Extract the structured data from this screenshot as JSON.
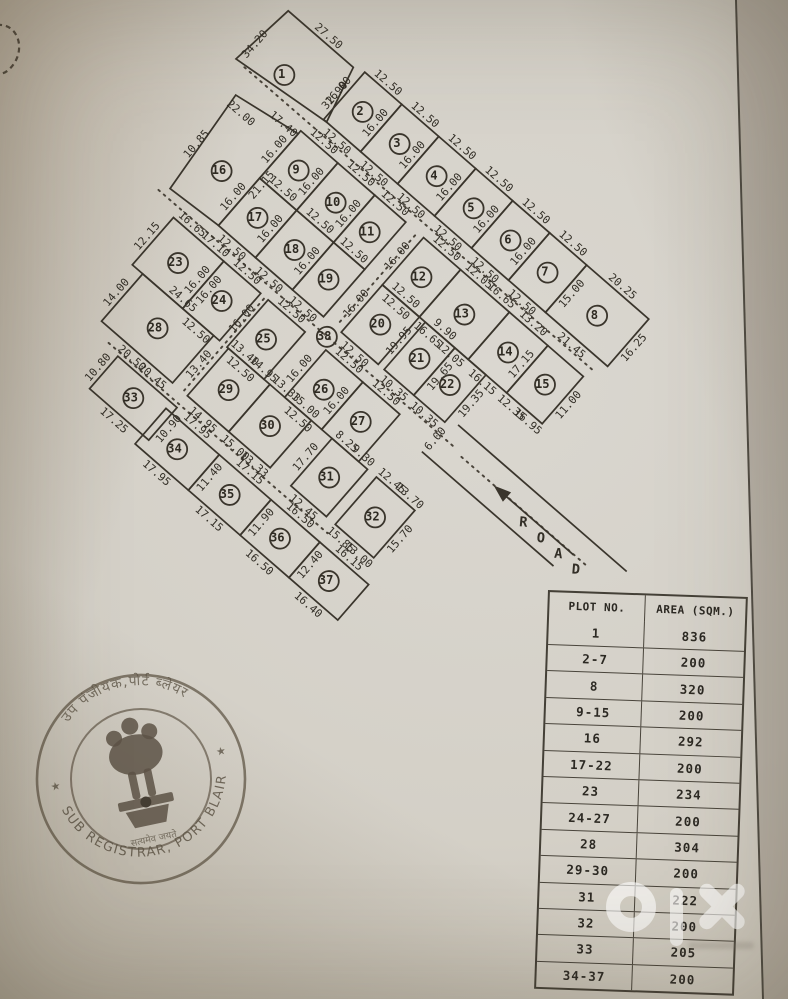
{
  "document": {
    "type_label": "site plan scan"
  },
  "table": {
    "headers": [
      "PLOT NO.",
      "AREA (SQM.)"
    ],
    "rows": [
      [
        "1",
        "836"
      ],
      [
        "2-7",
        "200"
      ],
      [
        "8",
        "320"
      ],
      [
        "9-15",
        "200"
      ],
      [
        "16",
        "292"
      ],
      [
        "17-22",
        "200"
      ],
      [
        "23",
        "234"
      ],
      [
        "24-27",
        "200"
      ],
      [
        "28",
        "304"
      ],
      [
        "29-30",
        "200"
      ],
      [
        "31",
        "222"
      ],
      [
        "32",
        "200"
      ],
      [
        "33",
        "205"
      ],
      [
        "34-37",
        "200"
      ]
    ]
  },
  "seal": {
    "top_text": "उप पंजीयक,पोर्ट ब्लेयर",
    "bottom_text": "SUB REGISTRAR, PORT BLAIR",
    "motto": "सत्यमेव जयते",
    "star": "★",
    "ink_color": "#564b3b"
  },
  "watermark": {
    "brand": "olx",
    "color": "#ffffff"
  },
  "colors": {
    "paper": "#d4d0c7",
    "ink": "#3a352c",
    "photo_edge": "#b0a898"
  },
  "map": {
    "road_label": "ROAD",
    "road_letter_pos": [
      [
        136.5,
        61
      ],
      [
        142.5,
        61.1
      ],
      [
        148.5,
        61.2
      ],
      [
        154.5,
        61.3
      ]
    ],
    "width_marks": [
      {
        "t": "6.00",
        "x": 105.8,
        "y": 58.8
      }
    ],
    "transform": {
      "ox": 276,
      "oy": -5,
      "deg": 41,
      "scale": 3.92
    },
    "roads_dotted": [
      [
        6,
        19.2,
        124,
        19.2
      ],
      [
        10,
        57.2,
        110,
        57.2
      ],
      [
        26,
        95,
        100,
        95
      ],
      [
        67,
        23,
        67,
        53.5
      ],
      [
        48.5,
        60.5,
        48.5,
        91.5
      ],
      [
        113,
        57.9,
        156,
        57.9
      ]
    ],
    "exit_lines": [
      [
        107,
        52.3,
        164,
        52.3
      ],
      [
        104.5,
        63.5,
        149,
        63.5
      ]
    ],
    "arrow_shaft": [
      151,
      58,
      126,
      58
    ],
    "arrow_head": "124,58 128.5,56.4 128.5,59.6",
    "plots": [
      {
        "n": "1",
        "poly": [
          [
            5,
            1
          ],
          [
            27,
            1
          ],
          [
            31,
            16
          ],
          [
            3,
            19
          ]
        ],
        "r": [
          3,
          1,
          28,
          18
        ],
        "c": [
          15,
          14
        ],
        "L": [
          [
            "27.50",
            "t"
          ],
          [
            "34.20",
            "@p",
            5,
            13
          ],
          [
            "32.90",
            "@p",
            29,
            9.5
          ]
        ]
      },
      {
        "n": "2",
        "r": [
          30,
          0,
          12.5,
          16
        ],
        "L": [
          [
            "12.50",
            "t"
          ],
          [
            "16.00",
            "l"
          ],
          [
            "12.50",
            "b"
          ]
        ]
      },
      {
        "n": "3",
        "r": [
          42.5,
          0,
          12.5,
          16
        ],
        "L": [
          [
            "12.50",
            "t"
          ],
          [
            "16.00",
            "l"
          ],
          [
            "12.50",
            "b"
          ]
        ]
      },
      {
        "n": "4",
        "r": [
          55,
          0,
          12.5,
          16
        ],
        "L": [
          [
            "12.50",
            "t"
          ],
          [
            "16.00",
            "l"
          ],
          [
            "12.50",
            "b"
          ]
        ]
      },
      {
        "n": "5",
        "r": [
          67.5,
          0,
          12.5,
          16
        ],
        "L": [
          [
            "12.50",
            "t"
          ],
          [
            "16.00",
            "l"
          ],
          [
            "12.50",
            "b"
          ]
        ]
      },
      {
        "n": "6",
        "r": [
          80,
          0,
          12.5,
          16
        ],
        "L": [
          [
            "12.50",
            "t"
          ],
          [
            "16.00",
            "l"
          ],
          [
            "12.50",
            "b"
          ]
        ]
      },
      {
        "n": "7",
        "r": [
          92.5,
          0,
          12.5,
          16
        ],
        "L": [
          [
            "12.50",
            "t"
          ],
          [
            "16.00",
            "l"
          ],
          [
            "15.00",
            "r"
          ],
          [
            "12.50",
            "b"
          ]
        ]
      },
      {
        "n": "8",
        "r": [
          105,
          0,
          21,
          16
        ],
        "L": [
          [
            "20.25",
            "t"
          ],
          [
            "16.25",
            "r"
          ],
          [
            "21.45",
            "b"
          ]
        ]
      },
      {
        "n": "16",
        "poly": [
          [
            9,
            26
          ],
          [
            27.5,
            23
          ],
          [
            27.5,
            54
          ],
          [
            12,
            55
          ]
        ],
        "r": [
          9,
          23,
          18.5,
          32
        ],
        "c": [
          19,
          43
        ],
        "L": [
          [
            "22.00",
            "@a",
            13,
            29.5
          ],
          [
            "17.40",
            "@a",
            23,
            24.5
          ],
          [
            "21.15",
            "@p",
            29.9,
            39
          ],
          [
            "10.85",
            "@p",
            10.5,
            42
          ]
        ]
      },
      {
        "n": "9",
        "r": [
          27.5,
          22,
          12.5,
          16
        ],
        "L": [
          [
            "12.50",
            "t"
          ],
          [
            "16.00",
            "l"
          ]
        ]
      },
      {
        "n": "10",
        "r": [
          40,
          22,
          12.5,
          16
        ],
        "L": [
          [
            "12.50",
            "t"
          ],
          [
            "16.00",
            "l"
          ]
        ]
      },
      {
        "n": "11",
        "r": [
          52.5,
          22,
          10.5,
          16
        ],
        "L": [
          [
            "12.50",
            "t"
          ],
          [
            "16.00",
            "l"
          ]
        ]
      },
      {
        "n": "12",
        "r": [
          69,
          22,
          12.5,
          16
        ],
        "L": [
          [
            "12.50",
            "t"
          ],
          [
            "16.00",
            "l"
          ],
          [
            "12.50",
            "b"
          ]
        ]
      },
      {
        "n": "13",
        "r": [
          81.5,
          22,
          16.5,
          16
        ],
        "L": [
          [
            "12.05",
            "t1"
          ],
          [
            "16.65",
            "t2"
          ],
          [
            "16.65",
            "b1"
          ],
          [
            "12.05",
            "b2"
          ]
        ]
      },
      {
        "n": "14",
        "r": [
          98,
          22,
          13,
          16
        ],
        "L": [
          [
            "13.20",
            "t"
          ],
          [
            "16.15",
            "b"
          ]
        ]
      },
      {
        "n": "15",
        "r": [
          111,
          22,
          12,
          16
        ],
        "L": [
          [
            "17.15",
            "l"
          ],
          [
            "11.00",
            "r"
          ],
          [
            "12.35",
            "b1"
          ],
          [
            "16.95",
            "b2"
          ]
        ]
      },
      {
        "n": "17",
        "r": [
          27.5,
          38,
          12.5,
          16
        ],
        "L": [
          [
            "12.50",
            "t"
          ],
          [
            "16.00",
            "l"
          ],
          [
            "12.50",
            "b"
          ]
        ]
      },
      {
        "n": "18",
        "r": [
          40,
          38,
          12.5,
          16
        ],
        "L": [
          [
            "12.50",
            "t"
          ],
          [
            "16.00",
            "l"
          ],
          [
            "12.50",
            "b"
          ]
        ]
      },
      {
        "n": "19",
        "r": [
          52.5,
          38,
          10.5,
          16
        ],
        "L": [
          [
            "12.50",
            "t"
          ],
          [
            "16.00",
            "l"
          ],
          [
            "12.50",
            "b"
          ]
        ]
      },
      {
        "n": "20",
        "r": [
          69,
          38,
          12.5,
          16
        ],
        "L": [
          [
            "12.50",
            "t"
          ],
          [
            "16.00",
            "l"
          ],
          [
            "12.50",
            "b"
          ]
        ]
      },
      {
        "n": "21",
        "r": [
          83.5,
          38,
          10,
          16
        ],
        "L": [
          [
            "9.90",
            "t"
          ],
          [
            "19.95",
            "l"
          ],
          [
            "19.65",
            "r"
          ],
          [
            "10.35",
            "b"
          ]
        ]
      },
      {
        "n": "22",
        "r": [
          93.5,
          38,
          10.5,
          16
        ],
        "L": [
          [
            "19.35",
            "r"
          ],
          [
            "10.35",
            "b"
          ]
        ]
      },
      {
        "n": "23",
        "r": [
          17.5,
          60,
          17,
          16
        ],
        "L": [
          [
            "16.65",
            "t1"
          ],
          [
            "17.10",
            "t2"
          ],
          [
            "12.15",
            "l"
          ],
          [
            "16.00",
            "r"
          ]
        ]
      },
      {
        "n": "24",
        "r": [
          34.5,
          60,
          12.5,
          16
        ],
        "L": [
          [
            "12.50",
            "t"
          ],
          [
            "16.00",
            "l"
          ],
          [
            "12.50",
            "b"
          ]
        ]
      },
      {
        "n": "25",
        "r": [
          49.5,
          60,
          12.5,
          16
        ],
        "L": [
          [
            "12.50",
            "t"
          ],
          [
            "16.00",
            "l"
          ],
          [
            "12.50",
            "b"
          ]
        ]
      },
      {
        "n": "26",
        "r": [
          69,
          60,
          12.5,
          16
        ],
        "L": [
          [
            "12.50",
            "t"
          ],
          [
            "16.00",
            "l"
          ],
          [
            "12.50",
            "b"
          ]
        ]
      },
      {
        "n": "27",
        "r": [
          81.5,
          60,
          12.5,
          16
        ],
        "L": [
          [
            "12.50",
            "t"
          ],
          [
            "16.00",
            "l"
          ]
        ]
      },
      {
        "n": "28",
        "r": [
          21,
          76,
          24,
          16
        ],
        "L": [
          [
            "24.65",
            "t"
          ],
          [
            "14.00",
            "l"
          ],
          [
            "13.40",
            "r"
          ],
          [
            "20.50",
            "b"
          ]
        ]
      },
      {
        "n": "29",
        "r": [
          50,
          76,
          14,
          16
        ],
        "L": [
          [
            "13.40",
            "t1"
          ],
          [
            "14.95",
            "t2"
          ],
          [
            "14.95",
            "b"
          ]
        ]
      },
      {
        "n": "30",
        "r": [
          64,
          76,
          14,
          16
        ],
        "L": [
          [
            "13.33",
            "t1"
          ],
          [
            "15.00",
            "t2"
          ],
          [
            "15.00",
            "b1"
          ],
          [
            "13.33",
            "b2"
          ]
        ]
      },
      {
        "n": "31",
        "r": [
          85,
          76,
          12,
          16
        ],
        "L": [
          [
            "8.25",
            "t1"
          ],
          [
            "9.30",
            "t2"
          ],
          [
            "17.70",
            "l"
          ],
          [
            "12.45",
            "b"
          ]
        ]
      },
      {
        "n": "32",
        "r": [
          100,
          76,
          13,
          16
        ],
        "L": [
          [
            "12.45",
            "t1"
          ],
          [
            "13.70",
            "t2"
          ],
          [
            "15.70",
            "r"
          ],
          [
            "15.85",
            "b1"
          ],
          [
            "13.00",
            "b2"
          ]
        ]
      },
      {
        "n": "33",
        "r": [
          30,
          96,
          20,
          11
        ],
        "L": [
          [
            "20.45",
            "t"
          ],
          [
            "10.80",
            "l"
          ],
          [
            "10.90",
            "r"
          ],
          [
            "17.25",
            "b"
          ]
        ]
      },
      {
        "n": "34",
        "r": [
          48,
          98,
          18,
          12
        ],
        "L": [
          [
            "17.95",
            "t"
          ],
          [
            "11.40",
            "r"
          ],
          [
            "17.95",
            "b"
          ]
        ]
      },
      {
        "n": "35",
        "r": [
          66,
          98,
          17.5,
          12
        ],
        "L": [
          [
            "17.15",
            "t"
          ],
          [
            "11.90",
            "r"
          ],
          [
            "17.15",
            "b"
          ]
        ]
      },
      {
        "n": "36",
        "r": [
          83.5,
          98,
          16.5,
          12
        ],
        "L": [
          [
            "16.50",
            "t"
          ],
          [
            "12.40",
            "r"
          ],
          [
            "16.50",
            "b"
          ]
        ]
      },
      {
        "n": "37",
        "r": [
          100,
          98,
          16.5,
          12
        ],
        "L": [
          [
            "16.15",
            "t"
          ],
          [
            "16.40",
            "b"
          ]
        ]
      },
      {
        "n": "38",
        "c": [
          67,
          57.3
        ]
      }
    ]
  }
}
